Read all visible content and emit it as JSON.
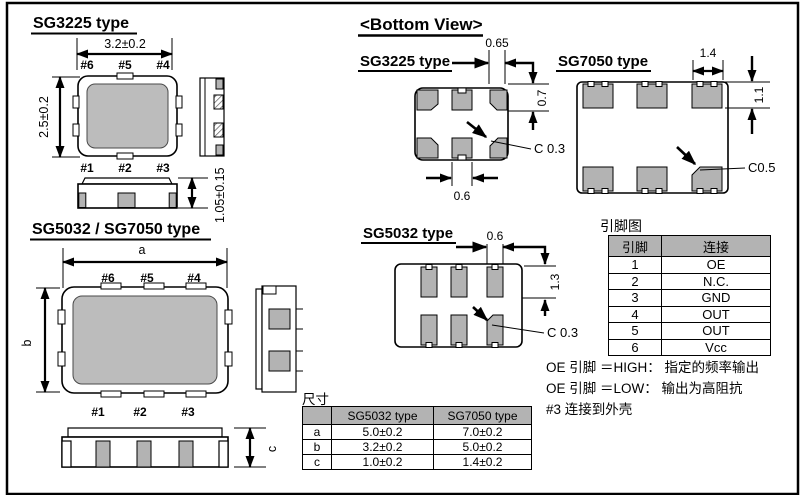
{
  "sg3225_top": {
    "title": "SG3225 type",
    "dim_width": "3.2±0.2",
    "dim_height": "2.5±0.2",
    "dim_thickness": "1.05±0.15",
    "pins_top": [
      "#6",
      "#5",
      "#4"
    ],
    "pins_bottom": [
      "#1",
      "#2",
      "#3"
    ]
  },
  "sg5032_7050_top": {
    "title": "SG5032 / SG7050 type",
    "dim_width": "a",
    "dim_height": "b",
    "dim_thickness": "c",
    "pins_top": [
      "#6",
      "#5",
      "#4"
    ],
    "pins_bottom": [
      "#1",
      "#2",
      "#3"
    ]
  },
  "bottom_view": {
    "title": "<Bottom View>",
    "sg3225": {
      "title": "SG3225 type",
      "corner_pad_width": "0.65",
      "pad_height": "0.7",
      "chamfer": "C 0.3",
      "center_pad_width": "0.6"
    },
    "sg7050": {
      "title": "SG7050 type",
      "pad_width": "1.4",
      "pad_height": "1.1",
      "chamfer": "C0.5"
    },
    "sg5032": {
      "title": "SG5032 type",
      "pad_width": "0.6",
      "pad_height": "1.3",
      "chamfer": "C 0.3"
    }
  },
  "pin_map": {
    "label": "引脚图",
    "col_pin": "引脚",
    "col_conn": "连接",
    "rows": [
      {
        "pin": "1",
        "conn": "OE"
      },
      {
        "pin": "2",
        "conn": "N.C."
      },
      {
        "pin": "3",
        "conn": "GND"
      },
      {
        "pin": "4",
        "conn": "OUT"
      },
      {
        "pin": "5",
        "conn": "OUT"
      },
      {
        "pin": "6",
        "conn": "Vcc"
      }
    ]
  },
  "notes": {
    "line1": "OE 引脚 ＝HIGH： 指定的频率输出",
    "line2": "OE 引脚 ＝LOW： 输出为高阻抗",
    "line3": "#3 连接到外壳"
  },
  "size_table": {
    "label": "尺寸",
    "col_sg5032": "SG5032 type",
    "col_sg7050": "SG7050 type",
    "rows": [
      {
        "param": "a",
        "sg5032": "5.0±0.2",
        "sg7050": "7.0±0.2"
      },
      {
        "param": "b",
        "sg5032": "3.2±0.2",
        "sg7050": "5.0±0.2"
      },
      {
        "param": "c",
        "sg5032": "1.0±0.2",
        "sg7050": "1.4±0.2"
      }
    ]
  },
  "colors": {
    "pad_gray": "#b3b3b3",
    "lid_gray": "#bcbcbc",
    "header_gray": "#b3b3b3",
    "line": "#000000"
  }
}
